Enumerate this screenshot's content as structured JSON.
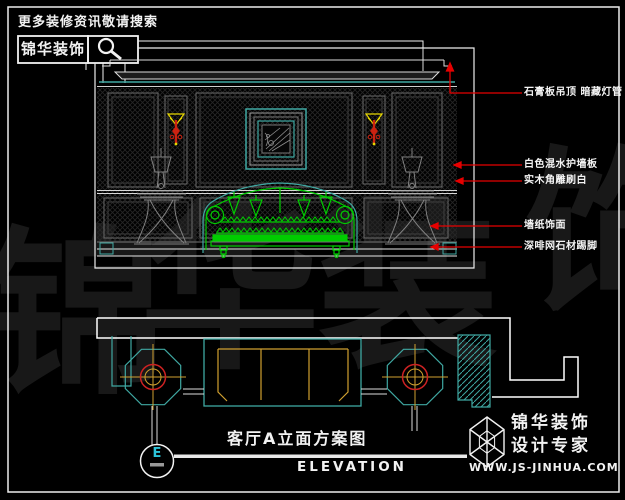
{
  "header": {
    "slogan": "更多装修资讯敬请搜索",
    "brand": "锦华装饰",
    "search_icon": "magnifier-icon"
  },
  "elevation": {
    "annotations": [
      {
        "label": "石膏板吊顶  暗藏灯管"
      },
      {
        "label": "白色混水护墙板"
      },
      {
        "label": "实木角雕刷白"
      },
      {
        "label": "墙纸饰面"
      },
      {
        "label": "深啡网石材踢脚"
      }
    ]
  },
  "watermark": {
    "chars": [
      "锦",
      "华",
      "装",
      "饰"
    ]
  },
  "title_block": {
    "marker_letter": "E",
    "title_cn": "客厅A立面方案图",
    "title_en": "ELEVATION"
  },
  "footer": {
    "logo_icon": "hexagon-cube-logo",
    "brand": "锦华装饰",
    "tagline": "设计专家",
    "website": "WWW.JS-JINHUA.COM"
  },
  "colors": {
    "background": "#000000",
    "line_white": "#ededed",
    "cyan_accent": "#3fa8a2",
    "sofa_green": "#00cc00",
    "annotation_red": "#e60000",
    "sconce_red": "#cc2211",
    "sconce_yellow": "#e8d800",
    "lamp_gold": "#d0a030",
    "panel_gray": "#6a6a6a",
    "watermark_gray": "#181818",
    "marker_letter_cyan": "#2cc4da"
  }
}
